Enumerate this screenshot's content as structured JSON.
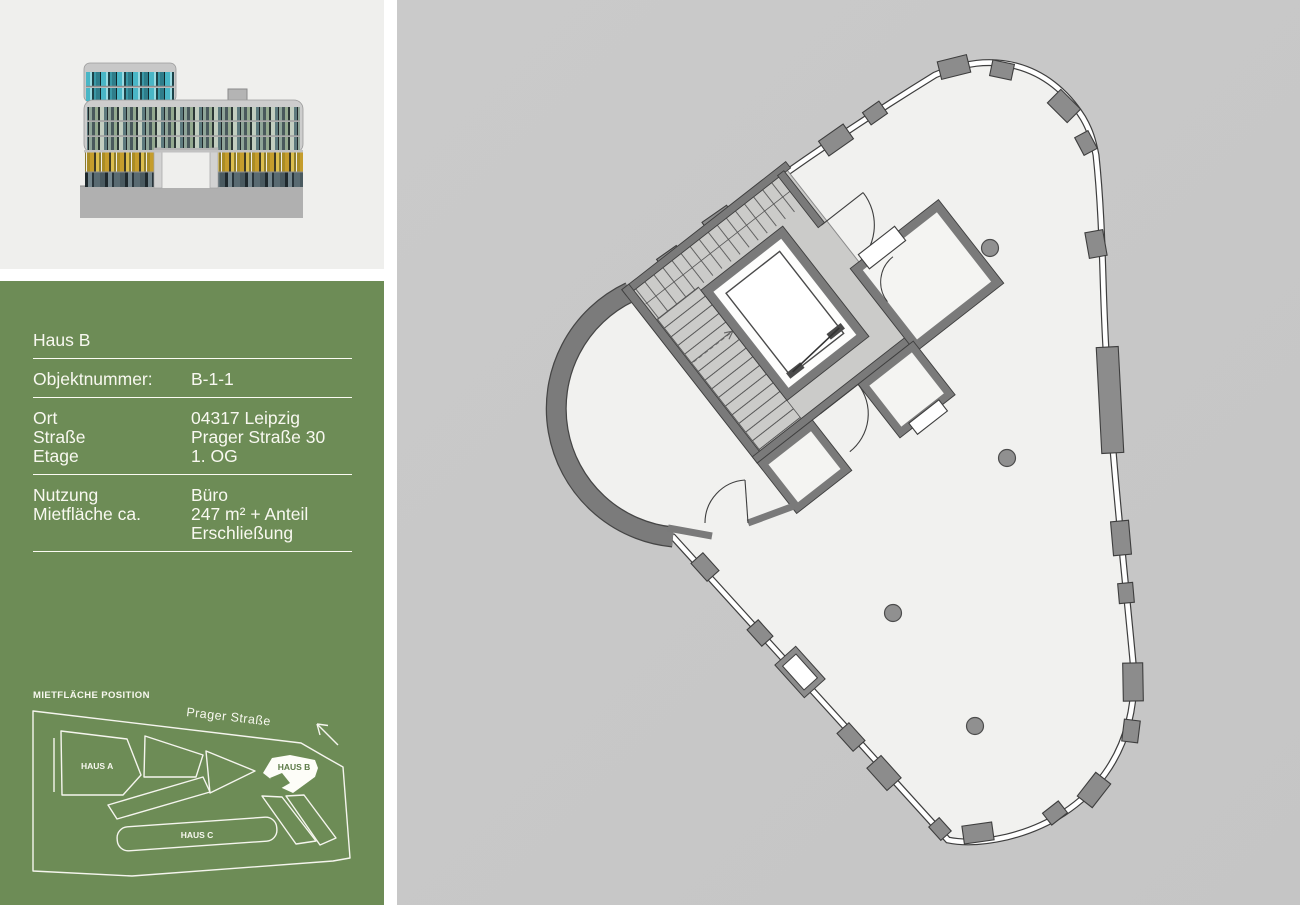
{
  "info_panel": {
    "title": "Haus B",
    "rows": [
      {
        "label": "Objektnummer:",
        "value": "B-1-1"
      },
      {
        "label": "Ort",
        "value": "04317  Leipzig"
      },
      {
        "label": "Straße",
        "value": "Prager Straße 30"
      },
      {
        "label": "Etage",
        "value": "1. OG"
      },
      {
        "label": "Nutzung",
        "value": "Büro"
      },
      {
        "label": "Mietfläche ca.",
        "value": "247  m² + Anteil"
      },
      {
        "label": "",
        "value": "Erschließung"
      }
    ]
  },
  "site_map": {
    "title": "MIETFLÄCHE POSITION",
    "street_label": "Prager Straße",
    "building_labels": [
      "HAUS A",
      "HAUS B",
      "HAUS C"
    ],
    "highlighted_building": "HAUS B",
    "north_arrow_icon": "north-arrow"
  },
  "floor_plan": {
    "core_icons": [
      "staircase",
      "elevator-shaft"
    ],
    "column_icon": "structural-column-dot"
  },
  "colors": {
    "accent_green": "#6d8c56",
    "panel_gray": "#c7c7c7",
    "wall_gray": "#7b7b7b",
    "floor_light": "#f1f1ef",
    "core_floor": "#cbcbc9",
    "elevation_bg": "#efefed",
    "text_on_green": "#f8f8f0"
  }
}
